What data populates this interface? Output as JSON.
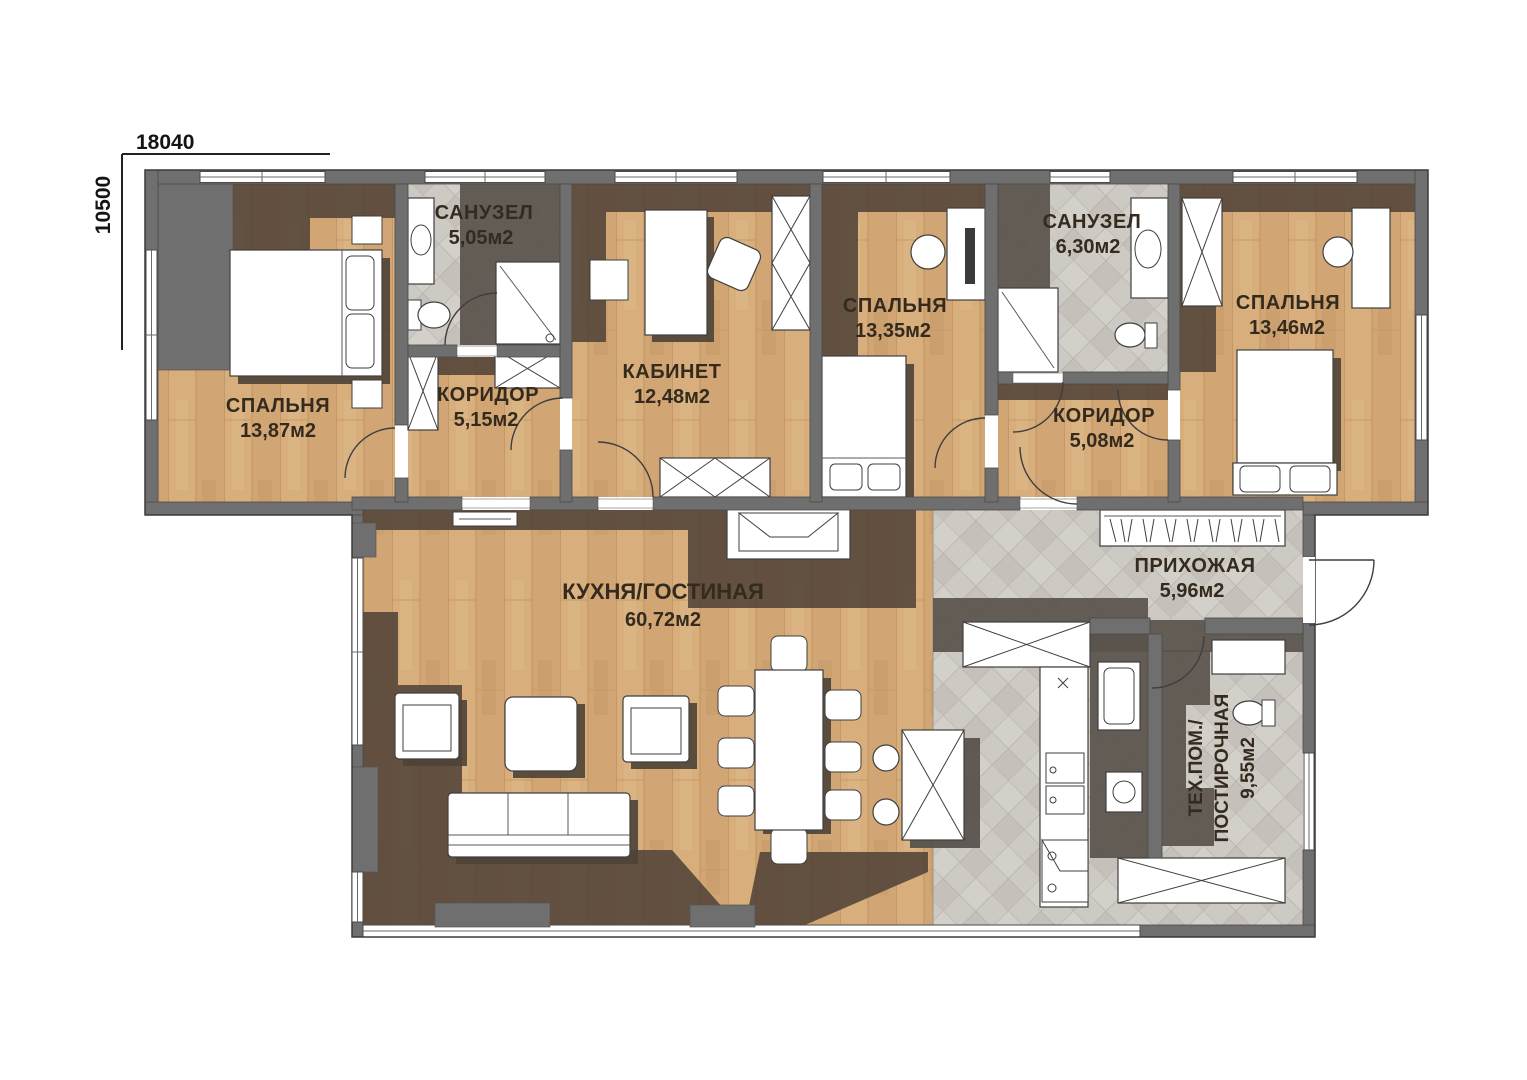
{
  "plan": {
    "dimensions": {
      "width_label": "18040",
      "height_label": "10500"
    },
    "rooms": {
      "bedroom1": {
        "name": "СПАЛЬНЯ",
        "area": "13,87м2"
      },
      "bathroom1": {
        "name": "САНУЗЕЛ",
        "area": "5,05м2"
      },
      "corridor1": {
        "name": "КОРИДОР",
        "area": "5,15м2"
      },
      "office": {
        "name": "КАБИНЕТ",
        "area": "12,48м2"
      },
      "bedroom2": {
        "name": "СПАЛЬНЯ",
        "area": "13,35м2"
      },
      "bathroom2": {
        "name": "САНУЗЕЛ",
        "area": "6,30м2"
      },
      "corridor2": {
        "name": "КОРИДОР",
        "area": "5,08м2"
      },
      "bedroom3": {
        "name": "СПАЛЬНЯ",
        "area": "13,46м2"
      },
      "kitchen_living": {
        "name": "КУХНЯ/ГОСТИНАЯ",
        "area": "60,72м2"
      },
      "hallway": {
        "name": "ПРИХОЖАЯ",
        "area": "5,96м2"
      },
      "tech_laundry": {
        "name_line1": "ТЕХ.ПОМ./",
        "name_line2": "ПОСТИРОЧНАЯ",
        "area": "9,55м2"
      }
    },
    "colors": {
      "wall": "#6f6f6f",
      "wood_floor": "#d7ae7c",
      "tile_floor": "#cdc9c3",
      "shadow_brown": "#55463a",
      "shadow_gray": "#5a544c",
      "furniture": "#ffffff",
      "label_text": "#342a1e",
      "dimension_text": "#141414"
    }
  }
}
